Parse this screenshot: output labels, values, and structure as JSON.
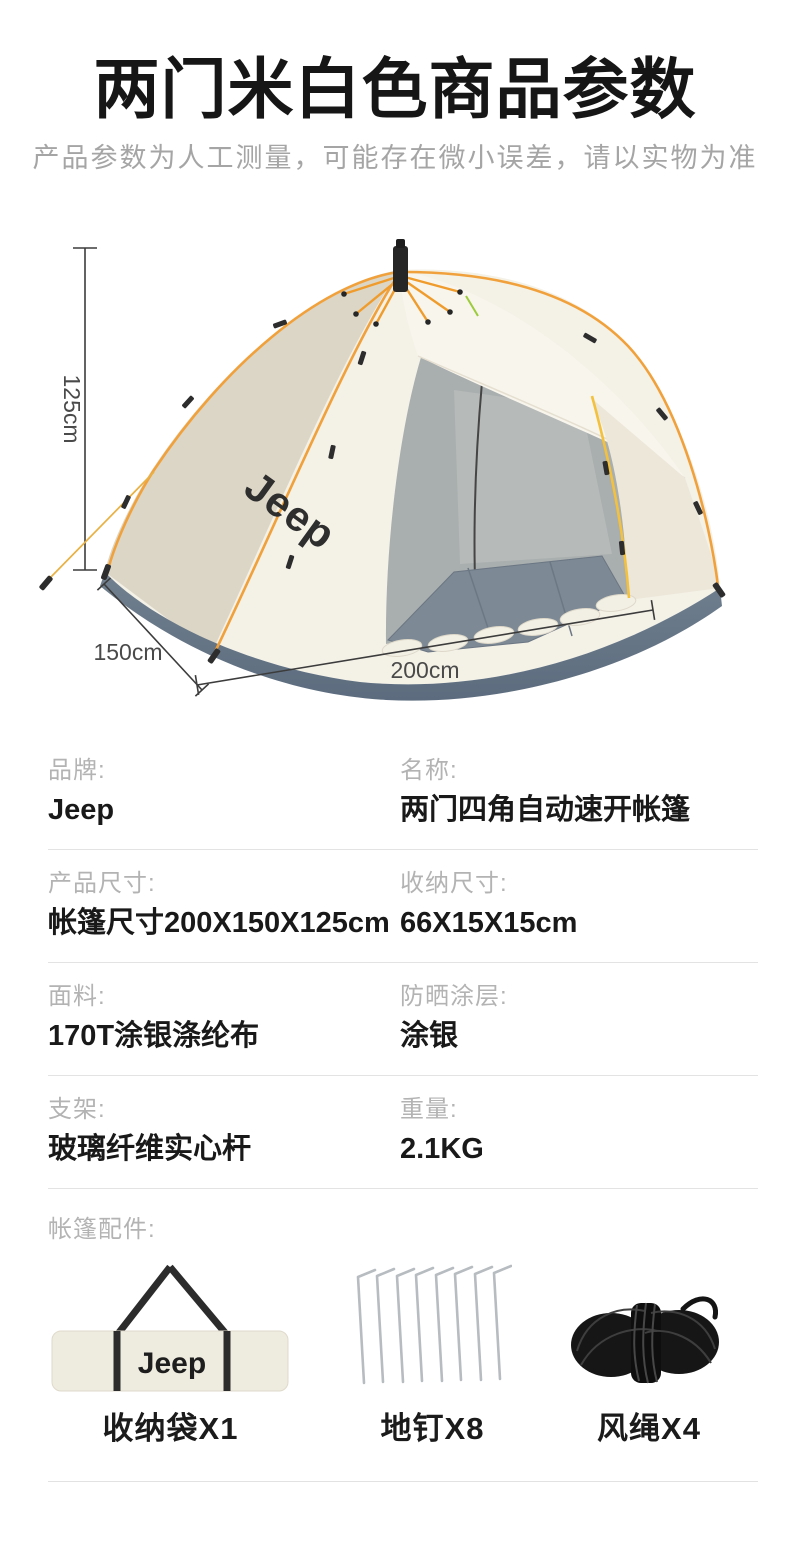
{
  "header": {
    "title": "两门米白色商品参数",
    "subtitle": "产品参数为人工测量，可能存在微小误差，请以实物为准"
  },
  "diagram": {
    "height_label": "125cm",
    "depth_label": "150cm",
    "width_label": "200cm",
    "tent_brand": "Jeep",
    "colors": {
      "canopy": "#f4f1e7",
      "canopy_shadow": "#dcd6c6",
      "awning": "#f8f5ed",
      "skirt_top": "#71808f",
      "skirt_bottom": "#5c6c7e",
      "floor_mat": "#7d8995",
      "interior_wall": "#a9aeae",
      "pole_orange": "#f1a13b",
      "pole_yellow": "#f3c13e",
      "hub_black": "#262626"
    }
  },
  "specs": {
    "rows": [
      {
        "left": {
          "label": "品牌:",
          "value": "Jeep"
        },
        "right": {
          "label": "名称:",
          "value": "两门四角自动速开帐篷"
        }
      },
      {
        "left": {
          "label": "产品尺寸:",
          "value": "帐篷尺寸200X150X125cm"
        },
        "right": {
          "label": "收纳尺寸:",
          "value": "66X15X15cm"
        }
      },
      {
        "left": {
          "label": "面料:",
          "value": "170T涂银涤纶布"
        },
        "right": {
          "label": "防晒涂层:",
          "value": "涂银"
        }
      },
      {
        "left": {
          "label": "支架:",
          "value": "玻璃纤维实心杆"
        },
        "right": {
          "label": "重量:",
          "value": "2.1KG"
        }
      }
    ]
  },
  "accessories": {
    "section_label": "帐篷配件:",
    "items": [
      {
        "label": "收纳袋X1",
        "icon": "storage-bag-icon",
        "bag_brand": "Jeep"
      },
      {
        "label": "地钉X8",
        "icon": "tent-stakes-icon"
      },
      {
        "label": "风绳X4",
        "icon": "wind-rope-icon"
      }
    ]
  }
}
